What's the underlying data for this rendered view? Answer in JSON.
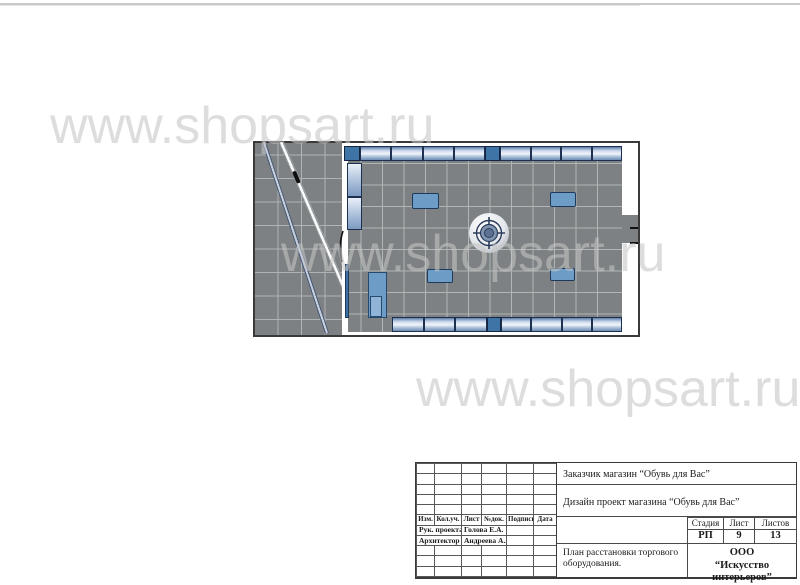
{
  "watermark": {
    "text": "www.shopsart.ru",
    "color": "#c6c6c6"
  },
  "title_block": {
    "client": "Заказчик магазин “Обувь для Вас”",
    "project": "Дизайн проект магазина “Обувь для Вас”",
    "columns": [
      "Изм.",
      "Кол.уч.",
      "Лист",
      "№док.",
      "Подпись",
      "Дата"
    ],
    "roles": [
      {
        "role": "Рук. проекта",
        "name": "Голова Е.А."
      },
      {
        "role": "Архитектор",
        "name": "Андреева А.А."
      }
    ],
    "stage_label": "Стадия",
    "sheet_label": "Лист",
    "sheets_label": "Листов",
    "stage": "РП",
    "sheet": "9",
    "sheets": "13",
    "drawing_title": "План расстановки торгового оборудования.",
    "company_line1": "ООО",
    "company_line2": "“Искусство интерьеров”"
  }
}
